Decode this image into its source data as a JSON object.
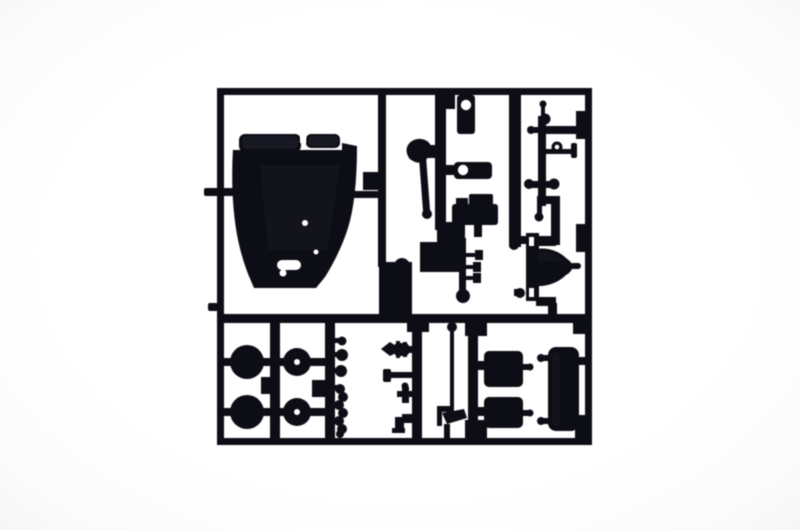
{
  "photo": {
    "description": "Overhead product photograph of a black injection-molded plastic model kit sprue (parts frame) holding unassembled vehicle model parts on a plain white background",
    "background_color": "#ffffff",
    "plastic_color": "#0e0f15",
    "highlight_color": "#2a2b34",
    "hole_color": "#ffffff",
    "parts": [
      {
        "id": "body-shell",
        "label": "car body shell with twin roof humps and molded holes"
      },
      {
        "id": "hole-bracket",
        "label": "small vertical bracket with round hole"
      },
      {
        "id": "gear-lever",
        "label": "curved lever with thin rod and ball end"
      },
      {
        "id": "eye-bracket",
        "label": "flat horizontal bracket with round hole"
      },
      {
        "id": "carburetor-block",
        "label": "carburetor block with twin stems"
      },
      {
        "id": "manifold-ladder",
        "label": "manifold stem with side fittings and ball end"
      },
      {
        "id": "pin-fittings",
        "label": "cluster of small pins, knobs and balls on runner"
      },
      {
        "id": "ring-eyelet",
        "label": "eyelet ring on thin rod"
      },
      {
        "id": "bell-housing",
        "label": "bell-shaped axle housing between two sleeves"
      },
      {
        "id": "wheel-disc-1",
        "label": "solid round wheel disc"
      },
      {
        "id": "wheel-disc-2",
        "label": "solid round wheel disc"
      },
      {
        "id": "hub-washer-1",
        "label": "hub disc with center hole"
      },
      {
        "id": "hub-washer-2",
        "label": "hub disc with center hole"
      },
      {
        "id": "bead-strip",
        "label": "column of small molded beads"
      },
      {
        "id": "spear-valve",
        "label": "spear-tipped valve fitting"
      },
      {
        "id": "push-rod",
        "label": "thin push rod with flat head"
      },
      {
        "id": "cross-pin",
        "label": "small cross-shaped pin"
      },
      {
        "id": "angle-bracket",
        "label": "small angle bracket"
      },
      {
        "id": "antenna-rod",
        "label": "long thin rod with ball tip and angled foot"
      },
      {
        "id": "seat-panel-1",
        "label": "rounded rectangular panel with side pin"
      },
      {
        "id": "seat-panel-2",
        "label": "rounded rectangular panel with side pin"
      },
      {
        "id": "tall-panel",
        "label": "tall rounded panel with corner pins"
      }
    ]
  }
}
